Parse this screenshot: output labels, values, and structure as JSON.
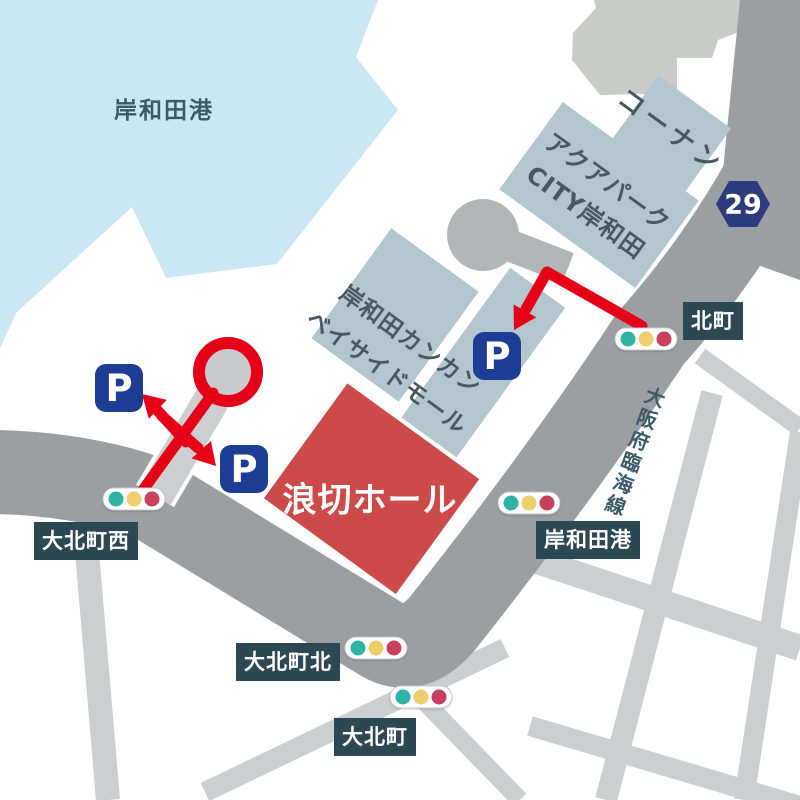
{
  "colors": {
    "water": "#cbe7f3",
    "water_text": "#3c5a68",
    "road": "#9b9fa1",
    "street": "#cbcfd0",
    "stub": "#cdced0",
    "bulb": "#c8cacc",
    "connector": "#b2b6b7",
    "grey_building": "#c9cbc9",
    "building": "#b3c6cd",
    "building_text": "#47585f",
    "label_bg": "#2c4852",
    "label_text": "#ffffff",
    "hall_red": "#cc4a49",
    "arrow_red": "#e60017",
    "parking_navy": "#1d3d94",
    "badge_navy": "#2c3b7d",
    "signal_teal": "#2eb3a4",
    "signal_yellow": "#eecf6d",
    "signal_red": "#c8405b",
    "pill_border": "#c9c9c9"
  },
  "map": {
    "water": {
      "label": "岸和田港"
    },
    "road": {
      "name": "大阪府臨海線",
      "route_number": "29"
    },
    "buildings": {
      "kohnan": {
        "label": "コーナン"
      },
      "aquapark": {
        "line1": "アクアパーク",
        "line2": "CITY岸和田"
      },
      "mall": {
        "line1": "岸和田カンカン",
        "line2": "ベイサイドモール"
      },
      "hall": {
        "label": "浪切ホール"
      }
    },
    "parking": {
      "mark": "P"
    },
    "intersections": {
      "kitamachi": {
        "label": "北町"
      },
      "kishiwadako": {
        "label": "岸和田港"
      },
      "okitacho_nishi": {
        "label": "大北町西"
      },
      "okitacho_kita": {
        "label": "大北町北"
      },
      "okitacho": {
        "label": "大北町"
      }
    }
  }
}
